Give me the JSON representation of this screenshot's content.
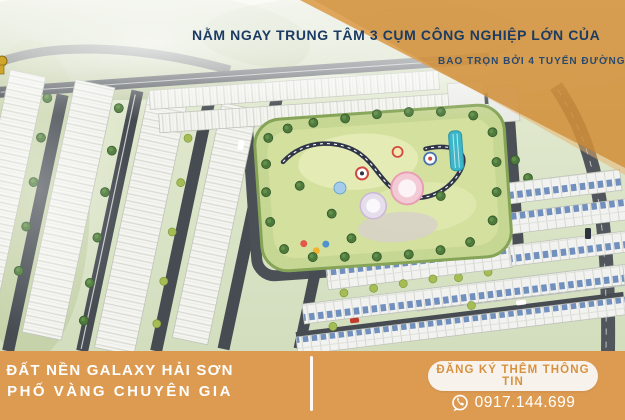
{
  "banner": {
    "headline": "NẰM NGAY TRUNG TÂM 3 CỤM CÔNG NGHIỆP LỚN CỦA",
    "subheadline": "BAO TRỌN BỞI 4 TUYẾN ĐƯỜNG"
  },
  "footer": {
    "project_title_line1": "ĐẤT NỀN GALAXY HẢI SƠN",
    "project_title_line2": "PHỐ VÀNG CHUYÊN GIA",
    "cta_button_label": "ĐĂNG KÝ THÊM THÔNG TIN",
    "phone_number": "0917.144.699",
    "phone_icon": "phone-circle-icon"
  },
  "colors": {
    "footer_bar_orange": "#DD9B52",
    "overlay_orange": "#D18F3A",
    "headline_navy": "#1C3B63",
    "button_bg": "#F7F3EC",
    "button_text_orange": "#D89140",
    "text_white": "#FFFFFF"
  }
}
